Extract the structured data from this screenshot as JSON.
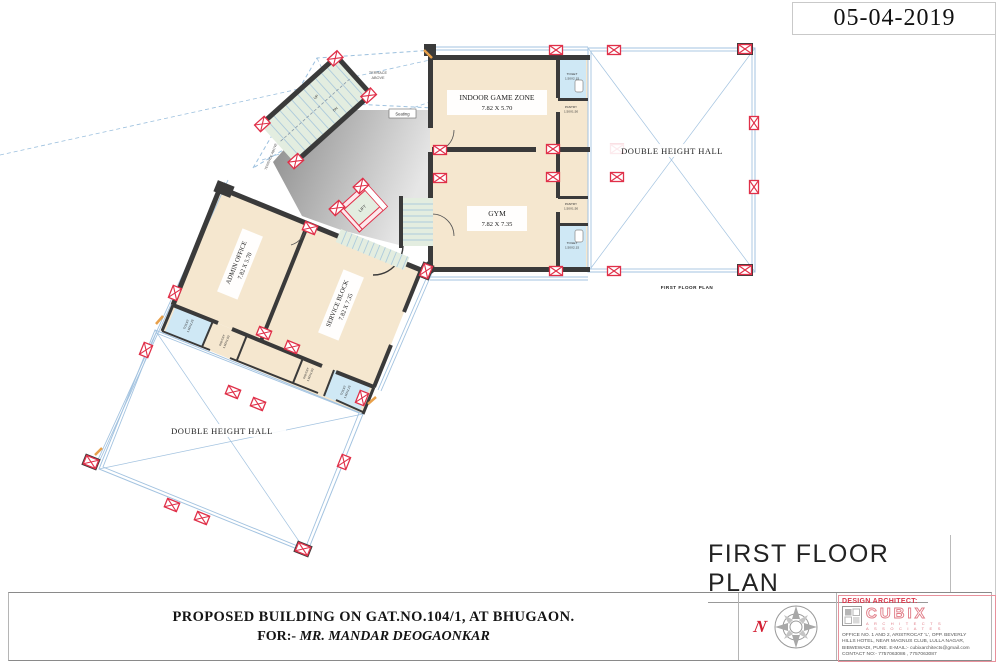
{
  "sheet": {
    "date": "05-04-2019",
    "plan_title": "FIRST FLOOR PLAN",
    "plan_caption": "FIRST FLOOR PLAN"
  },
  "plan": {
    "rooms": {
      "indoor_game_zone": {
        "name": "INDOOR GAME ZONE",
        "dim": "7.82 X 5.70"
      },
      "gym": {
        "name": "GYM",
        "dim": "7.82 X 7.35"
      },
      "admin_office": {
        "name": "ADMIN OFFICE",
        "dim": "7.82 X 5.70"
      },
      "service_block": {
        "name": "SERVICE BLOCK",
        "dim": "7.82 X 7.35"
      },
      "double_height_hall": "DOUBLE HEIGHT HALL",
      "toilet": {
        "name": "TOILET",
        "dim": "1.50X2.15"
      },
      "pantry": {
        "name": "PANTRY",
        "dim": "1.50X1.50"
      },
      "lift": "LIFT",
      "seating": "Seating",
      "up": "UP",
      "dn": "DN"
    },
    "annotations": {
      "terrace_above_1": "TERRACE",
      "terrace_above_2": "ABOVE",
      "terrace_above": "TERRACE ABOVE",
      "railing": "Railing for flr abv",
      "cutout": "Cutout"
    }
  },
  "titleblock": {
    "project_line1": "PROPOSED BUILDING ON GAT.NO.104/1, AT BHUGAON.",
    "project_line2_prefix": "FOR:-",
    "project_line2_name": "MR. MANDAR DEOGAONKAR",
    "north_letter": "N"
  },
  "architect": {
    "heading": "DESIGN ARCHITECT:",
    "brand": "CUBIX",
    "brand_line2": "A R C H I T E C T S",
    "brand_line3": "A S S O C I A T E S",
    "address_line1": "OFFICE NO. 1 AND 2, ARISTROCAT 'L', OPP. BEVERLY",
    "address_line2": "HILLS HOTEL, NEAR MAGNUS CLUB, LULLA NAGAR,",
    "address_line3": "BIBWEWADI, PUNE. E-MAIL:- cubixarchitects@gmail.com",
    "address_line4": "CONTACT NO:- 7757063086 , 7757063087"
  },
  "colors": {
    "wall": "#3a3a3a",
    "column_red": "#e03049",
    "glazing_blue": "#a3c3e0",
    "room_fill": "#f5e7cf",
    "toilet_fill": "#cfe8f5",
    "stair_fill": "#e3ede0",
    "accent_orange": "#e8a04a",
    "brand_red": "#e07a85"
  }
}
